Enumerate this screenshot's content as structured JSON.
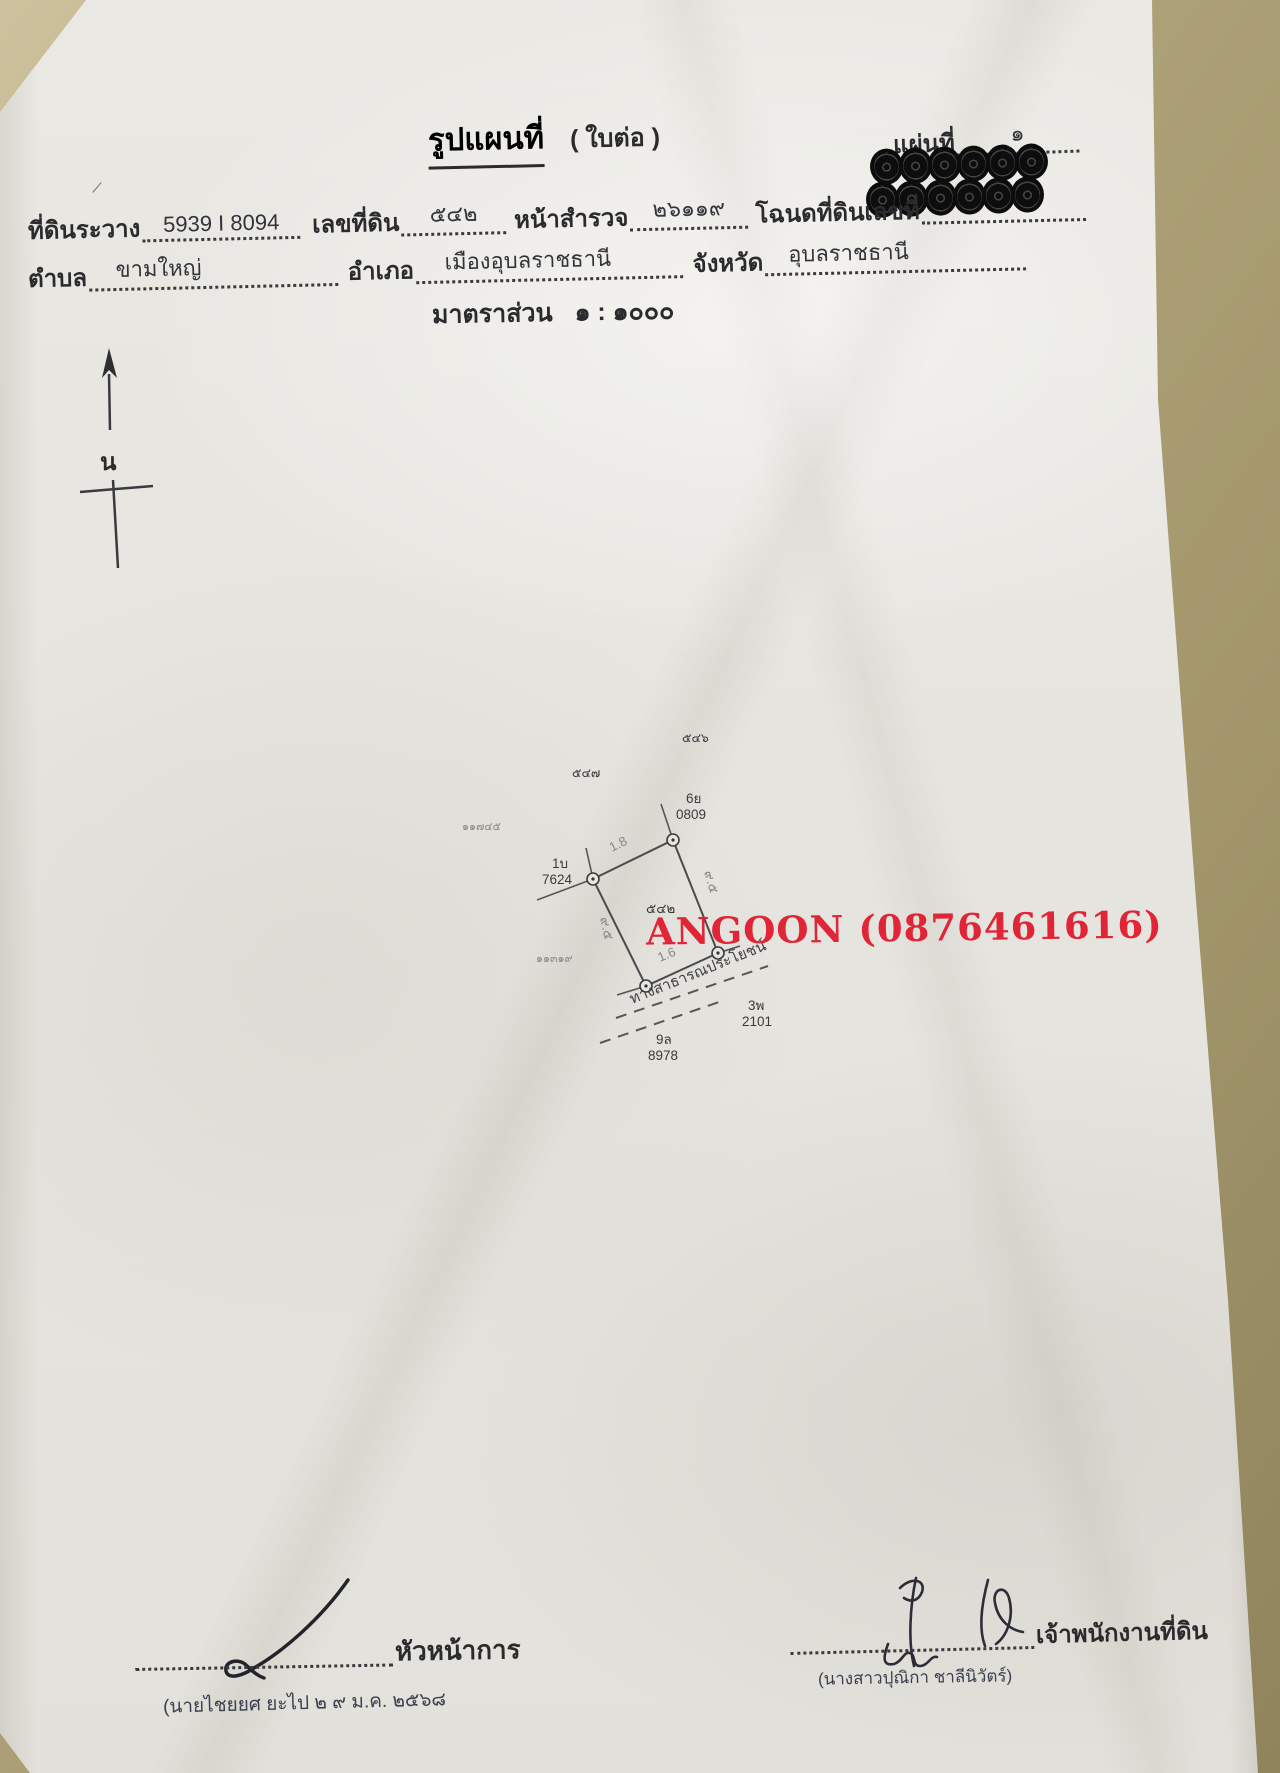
{
  "page": {
    "title": "รูปแผนที่",
    "title_suffix": "( ใบต่อ )",
    "sheet_label": "แผ่นที่",
    "sheet_number": "๑"
  },
  "fields": {
    "survey_sheet_label": "ที่ดินระวาง",
    "survey_sheet_value": "5939 I 8094",
    "parcel_no_label": "เลขที่ดิน",
    "parcel_no_value": "๕๔๒",
    "survey_page_label": "หน้าสำรวจ",
    "survey_page_value": "๒๖๑๑๙",
    "deed_no_label": "โฉนดที่ดินเลขที่",
    "deed_no_redaction_marks": 12,
    "subdistrict_label": "ตำบล",
    "subdistrict_value": "ขามใหญ่",
    "district_label": "อำเภอ",
    "district_value": "เมืองอุบลราชธานี",
    "province_label": "จังหวัด",
    "province_value": "อุบลราชธานี",
    "scale_label": "มาตราส่วน",
    "scale_value": "๑ : ๑๐๐๐"
  },
  "compass": {
    "north_label": "น"
  },
  "map": {
    "parcel_number": "๕๔๒",
    "neighbor_parcel_right": "๕๔๖",
    "neighbor_parcel_left": "๕๔๗",
    "pencil_number_left": "๑๑๗๔๕",
    "pencil_number_bottom": "๑๑๓๑๙",
    "marker_ne_code": "6ย",
    "marker_ne_number": "0809",
    "marker_w_code": "1บ",
    "marker_w_number": "7624",
    "marker_se_code": "3พ",
    "marker_se_number": "2101",
    "marker_s_code": "9ล",
    "marker_s_number": "8978",
    "dim_top": "1.8",
    "dim_bottom": "1.6",
    "dim_left": "๙.๕",
    "dim_right": "๙.๕",
    "road_label": "ทางสาธารณประโยชน์"
  },
  "watermark": {
    "text": "ANGOON (0876461616)",
    "color": "#e02537"
  },
  "signatures": {
    "left_title": "หัวหน้าการ",
    "left_stamp": "(นายไชยยศ ยะไป ๒ ๙ ม.ค. ๒๕๖๘",
    "right_title": "เจ้าพนักงานที่ดิน",
    "right_stamp": "(นางสาวปุณิกา ชาลีนิวัตร์)"
  },
  "colors": {
    "paper": "#e8e6e1",
    "backdrop": "#a3966b",
    "ink": "#2b2b2e",
    "stamp_ink": "#3a4050",
    "pencil": "#7a7a7e",
    "watermark_red": "#e02537"
  }
}
